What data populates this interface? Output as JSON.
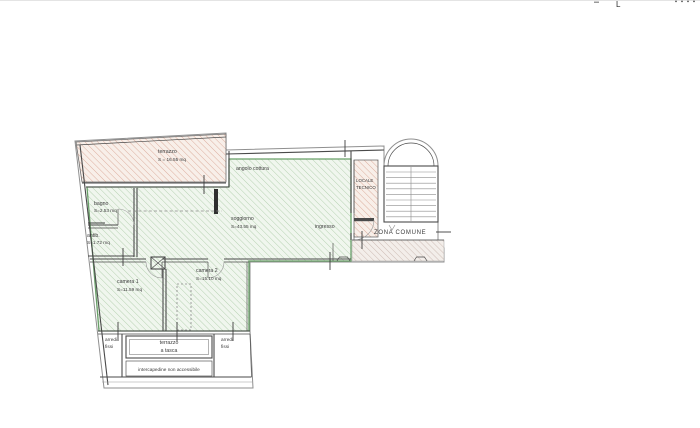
{
  "colors": {
    "wall": "#4a4a4a",
    "outline": "#8f8f8f",
    "green_border": "#69a069",
    "green_hatch": "#b7d2b2",
    "green_bg": "#f0f6ee",
    "pink_hatch": "#dcaf9f",
    "pink_bg": "#f8efe9",
    "gray_hatch": "#cdbcb4",
    "gray_bg": "#f3eeea",
    "text": "#3b3b3b",
    "dash": "#8a8a8a"
  },
  "artifacts": {
    "cropped_glyph": "L"
  },
  "rooms": {
    "terrazzo": {
      "label": "terrazzo",
      "area": "S = 16.55 mq"
    },
    "angolo_cottura": {
      "label": "angolo cottura"
    },
    "locale_tecnico": {
      "line1": "LOCALE",
      "line2": "TECNICO"
    },
    "soggiorno": {
      "label": "soggiorno",
      "area": "S=43.55 mq"
    },
    "ingresso": {
      "label": "ingresso"
    },
    "zona_comune": {
      "label": "ZONA COMUNE"
    },
    "bagno": {
      "label": "bagno",
      "area": "S=2.53 mq"
    },
    "antibagno": {
      "label": "antib.",
      "area": "S=1.72 mq"
    },
    "camera1": {
      "label": "camera 1",
      "area": "S=11.59 mq"
    },
    "camera2": {
      "label": "camera 2",
      "area": "S=15.10 mq"
    },
    "terrazzo_tasca": {
      "line1": "terrazzo",
      "line2": "a tasca"
    },
    "arredi_sx": {
      "line1": "arredi",
      "line2": "fissi"
    },
    "arredi_dx": {
      "line1": "arredi",
      "line2": "fissi"
    },
    "intercapedine": {
      "label": "intercapedine non accessibile"
    }
  }
}
